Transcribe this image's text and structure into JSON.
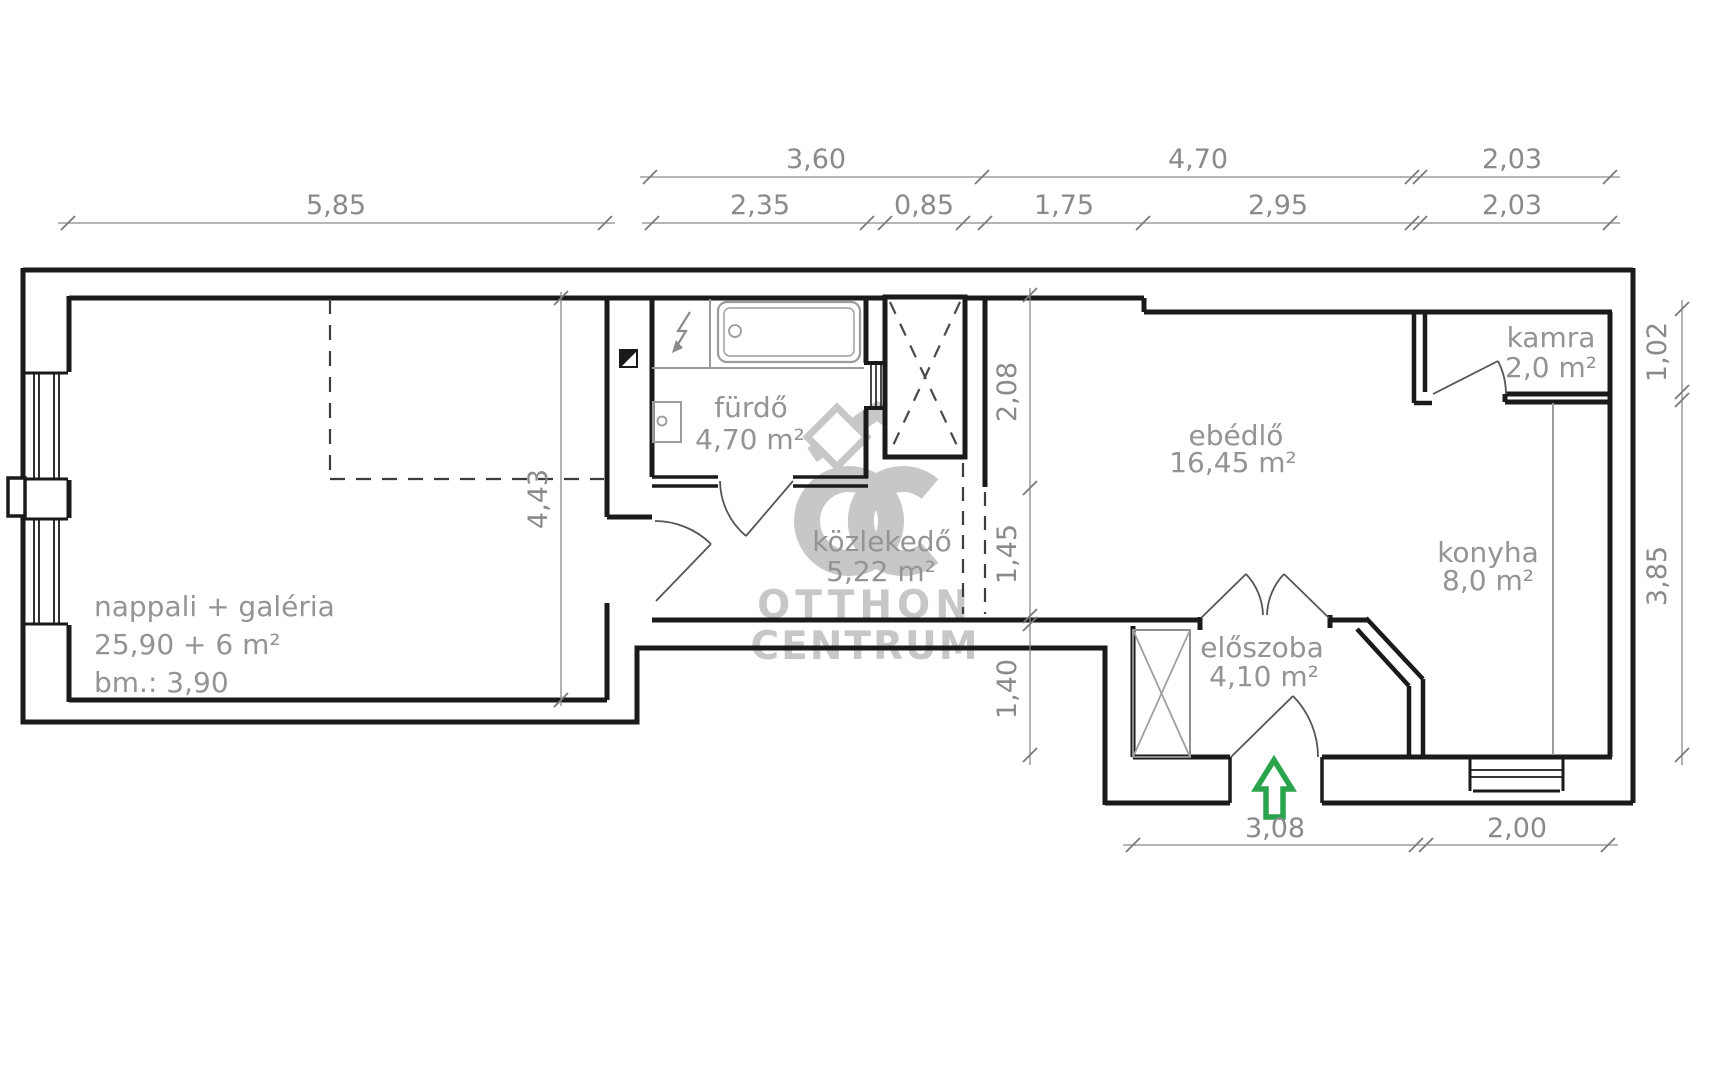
{
  "plan_title": "apartment floor plan",
  "rooms": {
    "nappali": {
      "line1": "nappali + galéria",
      "line2": "25,90 + 6 m²",
      "line3": "bm.: 3,90"
    },
    "furdo": {
      "name": "fürdő",
      "area": "4,70 m²"
    },
    "kozlekedo": {
      "name": "közlekedő",
      "area": "5,22 m²"
    },
    "ebedlo": {
      "name": "ebédlő",
      "area": "16,45 m²"
    },
    "kamra": {
      "name": "kamra",
      "area": "2,0 m²"
    },
    "konyha": {
      "name": "konyha",
      "area": "8,0 m²"
    },
    "eloszoba": {
      "name": "előszoba",
      "area": "4,10 m²"
    }
  },
  "dimensions": {
    "d360": "3,60",
    "d470": "4,70",
    "d203": "2,03",
    "d585": "5,85",
    "d235": "2,35",
    "d085": "0,85",
    "d175": "1,75",
    "d295": "2,95",
    "d308": "3,08",
    "d200": "2,00",
    "d208": "2,08",
    "d145": "1,45",
    "d140": "1,40",
    "d443": "4,43",
    "d102": "1,02",
    "d385": "3,85"
  },
  "watermark": {
    "monogram": "OC",
    "line1": "OTTHON",
    "line2": "CENTRUM"
  },
  "icons": {
    "entrance_arrow": "up-arrow",
    "electric_boiler": "lightning-bolt",
    "flue": "half-filled-square",
    "shaft": "dashed-x-box"
  },
  "colors": {
    "wall": "#1a1a1a",
    "fixture": "#9b9b9b",
    "door": "#555555",
    "dimension": "#8a8a8a",
    "label": "#949494",
    "watermark": "#9a9a9a",
    "entrance_arrow": "#2aa44c",
    "background": "#ffffff"
  }
}
